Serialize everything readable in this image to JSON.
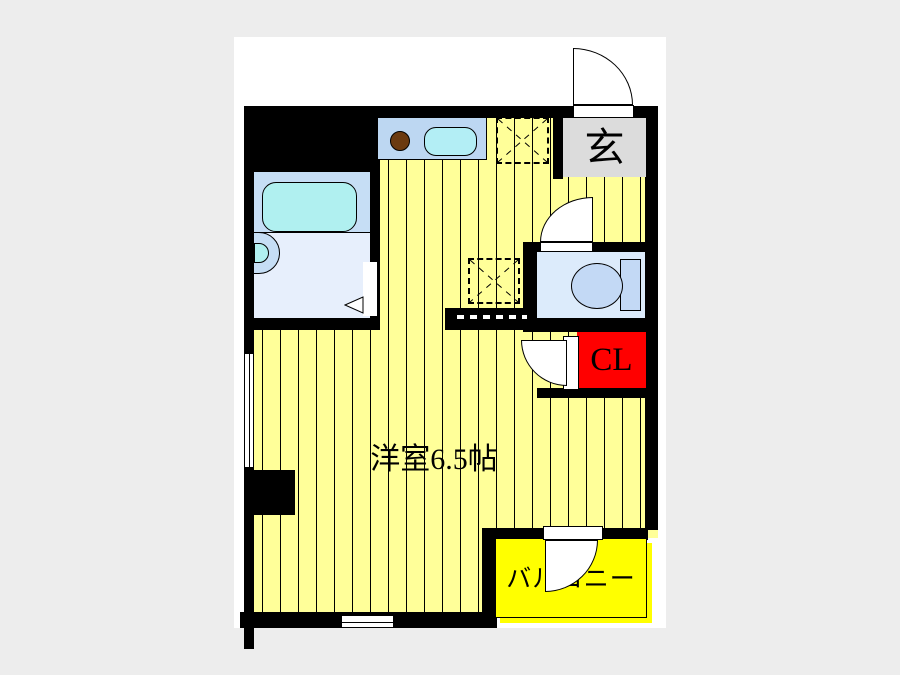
{
  "plan": {
    "labels": {
      "entrance": "玄",
      "closet": "CL",
      "main_room": "洋室6.5帖",
      "balcony": "バルコニー"
    },
    "colors": {
      "page_background": "#ededed",
      "paper": "#ffffff",
      "wall": "#000000",
      "floor": "#ffff99",
      "floor_stripe": "#000000",
      "balcony": "#ffff00",
      "closet": "#ff0000",
      "entrance": "#dcdcdc",
      "kitchen_counter": "#bdd7f2",
      "kitchen_sink": "#b3eef5",
      "bathroom_upper": "#c6def5",
      "bathroom_lower": "#e7effc",
      "bathtub": "#b0f0f0",
      "toilet_room": "#dcebfb",
      "toilet_fixture": "#c3d9f5",
      "burner": "#6b3a10"
    },
    "fixtures": [
      "kitchen-counter",
      "kitchen-sink",
      "gas-burner",
      "refrigerator-space",
      "washer-space",
      "bathtub",
      "washbasin",
      "toilet",
      "entrance-door",
      "toilet-door",
      "closet-door",
      "balcony-door",
      "bathroom-door",
      "window-left",
      "window-bottom",
      "pillar"
    ]
  }
}
